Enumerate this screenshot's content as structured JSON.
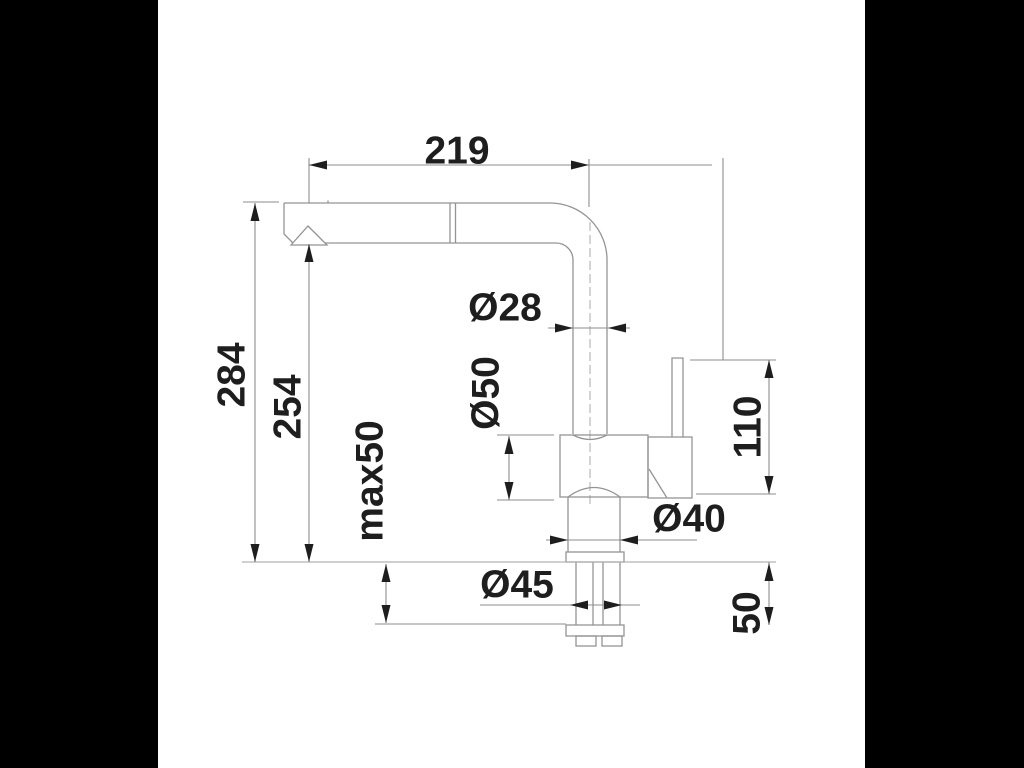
{
  "scene": {
    "background_color": "#000000",
    "canvas_color": "#ffffff",
    "outline_color": "#949494",
    "dimension_line_color": "#8e8e8e",
    "text_color": "#1e1e1e"
  },
  "labels": {
    "spout_reach": "219",
    "total_height": "284",
    "spout_height": "254",
    "max_deck_thickness": "max50",
    "spout_tube_diameter": "Ø28",
    "body_diameter": "Ø50",
    "base_diameter": "Ø40",
    "hole_diameter": "Ø45",
    "handle_height": "110",
    "shank_length": "50"
  }
}
